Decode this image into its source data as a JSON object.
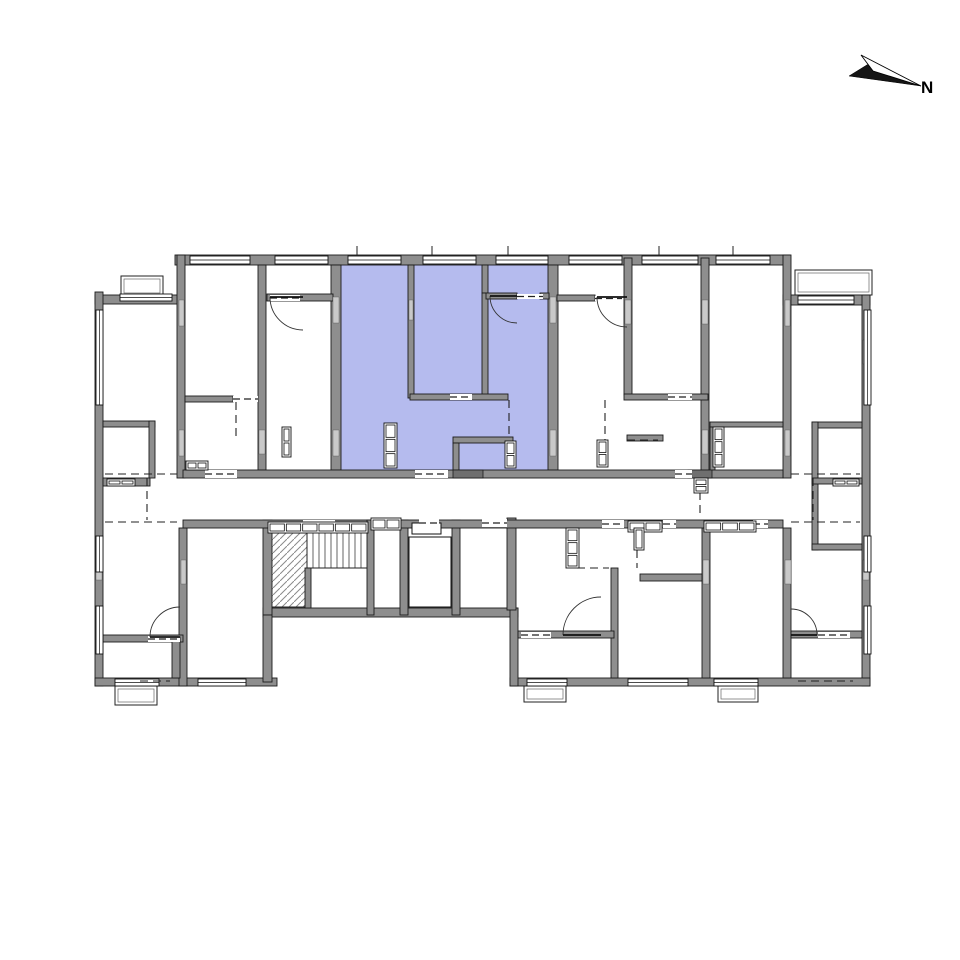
{
  "compass": {
    "label": "N"
  },
  "colors": {
    "highlight": "#b5bbee",
    "wall": "#8e8e8e",
    "wall_dark": "#6f6f6f",
    "wall_light": "#c9c9c9",
    "line": "#1b1b1b",
    "hatch": "#8a8a8a",
    "background": "#ffffff"
  },
  "plan": {
    "canvas": {
      "w": 960,
      "h": 960
    },
    "highlight": {
      "rect": [
        341,
        265,
        208,
        205
      ]
    },
    "balconies": [
      [
        121,
        276,
        42,
        20
      ],
      [
        795,
        270,
        77,
        25
      ],
      [
        115,
        686,
        42,
        19
      ],
      [
        524,
        686,
        42,
        16
      ],
      [
        718,
        686,
        40,
        16
      ]
    ],
    "stair": {
      "hatch": [
        267,
        533,
        40,
        74
      ],
      "treads": {
        "x0": 307,
        "step": 6,
        "n": 10,
        "y0": 533,
        "y1": 568
      },
      "base": [
        307,
        568,
        367,
        568
      ]
    },
    "elevator": {
      "car": [
        409,
        537,
        42,
        70
      ],
      "box": [
        412,
        523,
        29,
        11
      ]
    },
    "walls": [
      [
        175,
        255,
        615,
        10
      ],
      [
        95,
        295,
        88,
        9
      ],
      [
        95,
        292,
        8,
        394
      ],
      [
        95,
        678,
        182,
        8
      ],
      [
        783,
        295,
        87,
        10
      ],
      [
        862,
        295,
        8,
        391
      ],
      [
        510,
        678,
        360,
        8
      ],
      [
        263,
        608,
        255,
        9
      ],
      [
        263,
        520,
        9,
        95
      ],
      [
        263,
        615,
        9,
        67
      ],
      [
        510,
        608,
        8,
        78
      ],
      [
        177,
        255,
        8,
        223
      ],
      [
        783,
        255,
        8,
        223
      ],
      [
        331,
        265,
        10,
        205
      ],
      [
        548,
        265,
        10,
        205
      ],
      [
        258,
        265,
        8,
        205
      ],
      [
        624,
        258,
        8,
        137
      ],
      [
        701,
        258,
        8,
        220
      ],
      [
        408,
        265,
        6,
        133
      ],
      [
        482,
        265,
        6,
        28
      ],
      [
        482,
        293,
        6,
        104
      ],
      [
        486,
        293,
        31,
        6
      ],
      [
        540,
        293,
        9,
        6
      ],
      [
        410,
        394,
        98,
        6
      ],
      [
        453,
        437,
        60,
        6
      ],
      [
        453,
        443,
        6,
        27
      ],
      [
        267,
        294,
        66,
        7
      ],
      [
        185,
        396,
        48,
        6
      ],
      [
        557,
        295,
        38,
        6
      ],
      [
        624,
        394,
        84,
        6
      ],
      [
        627,
        435,
        36,
        6
      ],
      [
        710,
        422,
        73,
        5
      ],
      [
        710,
        427,
        5,
        43
      ],
      [
        812,
        422,
        50,
        6
      ],
      [
        812,
        422,
        6,
        128
      ],
      [
        812,
        478,
        50,
        6
      ],
      [
        812,
        544,
        50,
        6
      ],
      [
        103,
        421,
        52,
        6
      ],
      [
        149,
        421,
        6,
        57
      ],
      [
        103,
        478,
        47,
        8
      ],
      [
        179,
        528,
        8,
        158
      ],
      [
        103,
        635,
        80,
        7
      ],
      [
        172,
        637,
        8,
        41
      ],
      [
        611,
        568,
        7,
        110
      ],
      [
        702,
        528,
        8,
        150
      ],
      [
        783,
        528,
        8,
        150
      ],
      [
        518,
        631,
        96,
        7
      ],
      [
        791,
        631,
        71,
        7
      ],
      [
        640,
        574,
        62,
        7
      ],
      [
        400,
        520,
        8,
        95
      ],
      [
        452,
        520,
        8,
        95
      ],
      [
        507,
        518,
        9,
        92
      ],
      [
        183,
        470,
        600,
        8
      ],
      [
        183,
        520,
        600,
        8
      ],
      [
        367,
        520,
        7,
        95
      ],
      [
        305,
        568,
        6,
        40
      ]
    ],
    "dark_piers": [
      [
        453,
        470,
        30,
        8
      ],
      [
        688,
        470,
        24,
        8
      ]
    ],
    "piers": [
      [
        333,
        297,
        6,
        26
      ],
      [
        333,
        430,
        6,
        26
      ],
      [
        550,
        297,
        6,
        26
      ],
      [
        550,
        430,
        6,
        26
      ],
      [
        179,
        300,
        5,
        26
      ],
      [
        179,
        430,
        5,
        26
      ],
      [
        785,
        300,
        5,
        26
      ],
      [
        785,
        430,
        5,
        26
      ],
      [
        259,
        430,
        6,
        24
      ],
      [
        625,
        300,
        6,
        24
      ],
      [
        702,
        300,
        6,
        24
      ],
      [
        702,
        430,
        6,
        24
      ],
      [
        96,
        340,
        6,
        24
      ],
      [
        863,
        340,
        6,
        24
      ],
      [
        181,
        560,
        5,
        24
      ],
      [
        703,
        560,
        6,
        24
      ],
      [
        785,
        560,
        6,
        24
      ],
      [
        96,
        560,
        6,
        20
      ],
      [
        863,
        560,
        6,
        20
      ],
      [
        409,
        300,
        4,
        20
      ]
    ],
    "windows": [
      [
        190,
        256,
        60,
        8,
        "h"
      ],
      [
        275,
        256,
        53,
        8,
        "h"
      ],
      [
        348,
        256,
        53,
        8,
        "h"
      ],
      [
        423,
        256,
        53,
        8,
        "h"
      ],
      [
        496,
        256,
        52,
        8,
        "h"
      ],
      [
        569,
        256,
        53,
        8,
        "h"
      ],
      [
        642,
        256,
        56,
        8,
        "h"
      ],
      [
        716,
        256,
        54,
        8,
        "h"
      ],
      [
        120,
        294,
        52,
        7,
        "h"
      ],
      [
        798,
        296,
        56,
        8,
        "h"
      ],
      [
        96,
        310,
        7,
        95,
        "v"
      ],
      [
        96,
        536,
        7,
        36,
        "v"
      ],
      [
        96,
        606,
        7,
        48,
        "v"
      ],
      [
        864,
        310,
        7,
        95,
        "v"
      ],
      [
        864,
        536,
        7,
        36,
        "v"
      ],
      [
        864,
        606,
        7,
        48,
        "v"
      ],
      [
        115,
        679,
        44,
        7,
        "h"
      ],
      [
        198,
        679,
        48,
        7,
        "h"
      ],
      [
        527,
        679,
        40,
        7,
        "h"
      ],
      [
        628,
        679,
        60,
        7,
        "h"
      ],
      [
        714,
        679,
        44,
        7,
        "h"
      ]
    ],
    "openings": [
      [
        205,
        470,
        32,
        8
      ],
      [
        415,
        470,
        33,
        8
      ],
      [
        675,
        470,
        17,
        8
      ],
      [
        303,
        520,
        32,
        8
      ],
      [
        602,
        520,
        22,
        8
      ],
      [
        663,
        520,
        13,
        8
      ],
      [
        753,
        520,
        15,
        8
      ],
      [
        482,
        519,
        25,
        8
      ],
      [
        419,
        519,
        20,
        8
      ],
      [
        450,
        394,
        22,
        6
      ],
      [
        668,
        394,
        24,
        6
      ],
      [
        148,
        636,
        32,
        6
      ],
      [
        233,
        396,
        25,
        6
      ],
      [
        270,
        295,
        30,
        6
      ],
      [
        517,
        294,
        26,
        5
      ],
      [
        595,
        296,
        27,
        5
      ],
      [
        818,
        632,
        32,
        6
      ],
      [
        521,
        632,
        30,
        6
      ]
    ],
    "dashes": [
      [
        105,
        474,
        177,
        474
      ],
      [
        105,
        522,
        177,
        522
      ],
      [
        791,
        474,
        860,
        474
      ],
      [
        791,
        522,
        860,
        522
      ],
      [
        147,
        478,
        147,
        520
      ],
      [
        813,
        478,
        813,
        520
      ],
      [
        509,
        400,
        509,
        437
      ],
      [
        605,
        400,
        605,
        440
      ],
      [
        236,
        402,
        236,
        437
      ],
      [
        637,
        550,
        637,
        568
      ],
      [
        577,
        568,
        609,
        568
      ],
      [
        700,
        492,
        700,
        516
      ],
      [
        798,
        681,
        853,
        681
      ],
      [
        140,
        681,
        170,
        681
      ],
      [
        627,
        440,
        658,
        440
      ]
    ],
    "ticks": [
      [
        357,
        246,
        357,
        256
      ],
      [
        432,
        246,
        432,
        256
      ],
      [
        508,
        246,
        508,
        256
      ],
      [
        659,
        246,
        659,
        256
      ],
      [
        733,
        246,
        733,
        256
      ]
    ],
    "fixtures": [
      {
        "r": [
          384,
          423,
          13,
          45
        ],
        "n": 3,
        "dir": "v"
      },
      {
        "r": [
          505,
          441,
          11,
          27
        ],
        "n": 2,
        "dir": "v"
      },
      {
        "r": [
          597,
          440,
          11,
          27
        ],
        "n": 2,
        "dir": "v"
      },
      {
        "r": [
          713,
          427,
          11,
          40
        ],
        "n": 3,
        "dir": "v"
      },
      {
        "r": [
          282,
          427,
          9,
          30
        ],
        "n": 2,
        "dir": "v"
      },
      {
        "r": [
          186,
          461,
          22,
          9
        ],
        "n": 2,
        "dir": "h"
      },
      {
        "r": [
          268,
          522,
          100,
          11
        ],
        "n": 6,
        "dir": "h"
      },
      {
        "r": [
          371,
          518,
          30,
          12
        ],
        "n": 2,
        "dir": "h"
      },
      {
        "r": [
          704,
          521,
          52,
          11
        ],
        "n": 3,
        "dir": "h"
      },
      {
        "r": [
          628,
          521,
          34,
          11
        ],
        "n": 2,
        "dir": "h"
      },
      {
        "r": [
          566,
          528,
          13,
          40
        ],
        "n": 3,
        "dir": "v"
      },
      {
        "r": [
          634,
          528,
          10,
          22
        ],
        "n": 1,
        "dir": "v"
      },
      {
        "r": [
          107,
          479,
          28,
          7
        ],
        "n": 2,
        "dir": "h"
      },
      {
        "r": [
          833,
          479,
          26,
          7
        ],
        "n": 2,
        "dir": "h"
      },
      {
        "r": [
          694,
          478,
          14,
          15
        ],
        "n": 2,
        "dir": "v"
      }
    ],
    "doors": [
      {
        "p": [
          303,
          297
        ],
        "t": [
          270,
          297
        ],
        "e": [
          303,
          330
        ],
        "s": 0
      },
      {
        "p": [
          517,
          296
        ],
        "t": [
          490,
          296
        ],
        "e": [
          517,
          323
        ],
        "s": 0
      },
      {
        "p": [
          627,
          297
        ],
        "t": [
          597,
          297
        ],
        "e": [
          627,
          327
        ],
        "s": 0
      },
      {
        "p": [
          180,
          637
        ],
        "t": [
          150,
          637
        ],
        "e": [
          180,
          607
        ],
        "s": 1
      },
      {
        "p": [
          601,
          635
        ],
        "t": [
          563,
          635
        ],
        "e": [
          601,
          597
        ],
        "s": 1
      },
      {
        "p": [
          791,
          635
        ],
        "t": [
          817,
          635
        ],
        "e": [
          791,
          609
        ],
        "s": 0
      }
    ],
    "north_arrow": {
      "dark": [
        [
          849,
          76
        ],
        [
          921,
          86
        ],
        [
          870,
          63
        ]
      ],
      "light": [
        [
          861,
          55
        ],
        [
          921,
          86
        ],
        [
          873,
          71
        ]
      ]
    }
  }
}
